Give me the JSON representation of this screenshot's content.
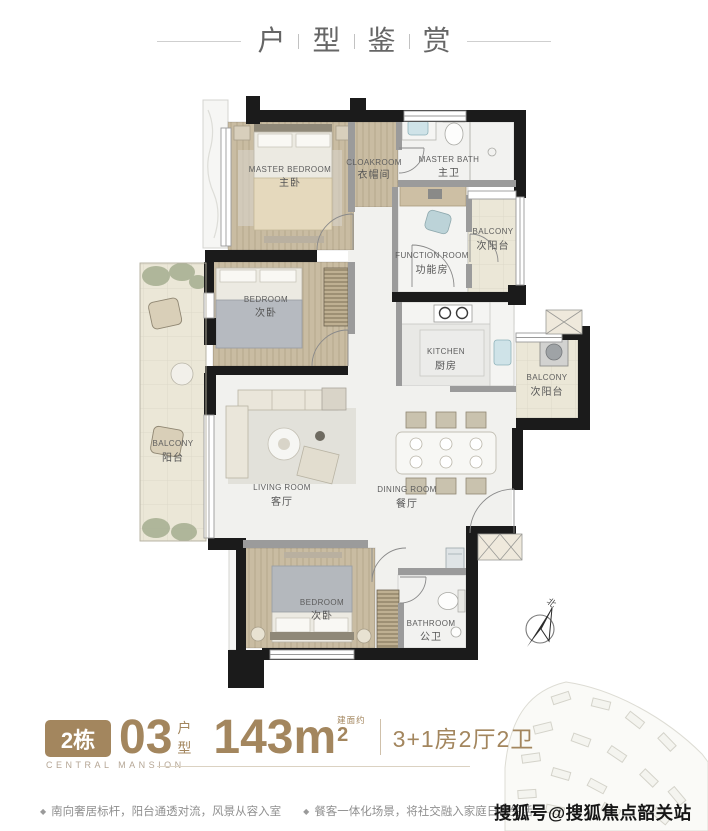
{
  "title": {
    "chars": [
      "户",
      "型",
      "鉴",
      "赏"
    ]
  },
  "plan": {
    "compass": "北",
    "rooms": {
      "master_bedroom": {
        "en": "MASTER BEDROOM",
        "cn": "主卧"
      },
      "cloakroom": {
        "en": "CLOAKROOM",
        "cn": "衣帽间"
      },
      "master_bath": {
        "en": "MASTER BATH",
        "cn": "主卫"
      },
      "balcony_top_right": {
        "en": "BALCONY",
        "cn": "次阳台"
      },
      "function_room": {
        "en": "FUNCTION ROOM",
        "cn": "功能房"
      },
      "bedroom_2": {
        "en": "BEDROOM",
        "cn": "次卧"
      },
      "balcony_left": {
        "en": "BALCONY",
        "cn": "阳台"
      },
      "living_room": {
        "en": "LIVING ROOM",
        "cn": "客厅"
      },
      "dining_room": {
        "en": "DINING ROOM",
        "cn": "餐厅"
      },
      "kitchen": {
        "en": "KITCHEN",
        "cn": "厨房"
      },
      "balcony_right": {
        "en": "BALCONY",
        "cn": "次阳台"
      },
      "bedroom_3": {
        "en": "BEDROOM",
        "cn": "次卧"
      },
      "bathroom": {
        "en": "BATHROOM",
        "cn": "公卫"
      }
    }
  },
  "info": {
    "building_badge": "2栋",
    "unit_number": "03",
    "unit_type_chars": [
      "户",
      "型"
    ],
    "area_value": "143m",
    "area_sup": "2",
    "area_note": "建面约",
    "layout_spec": "3+1房2厅2卫",
    "brand": "CENTRAL MANSION"
  },
  "features": [
    "南向奢居标杆，阳台通透对流，风景从容入室",
    "餐客一体化场景，将社交融入家庭日常生活"
  ],
  "watermark": "搜狐号@搜狐焦点韶关站",
  "colors": {
    "accent_brown": "#a3865e",
    "wall_black": "#1b1b1b",
    "wood_floor": "#c9bca2",
    "balcony_tile": "#ebe7d7",
    "marble_floor": "#f2f2f0",
    "label_gray": "#5d5d5d"
  }
}
